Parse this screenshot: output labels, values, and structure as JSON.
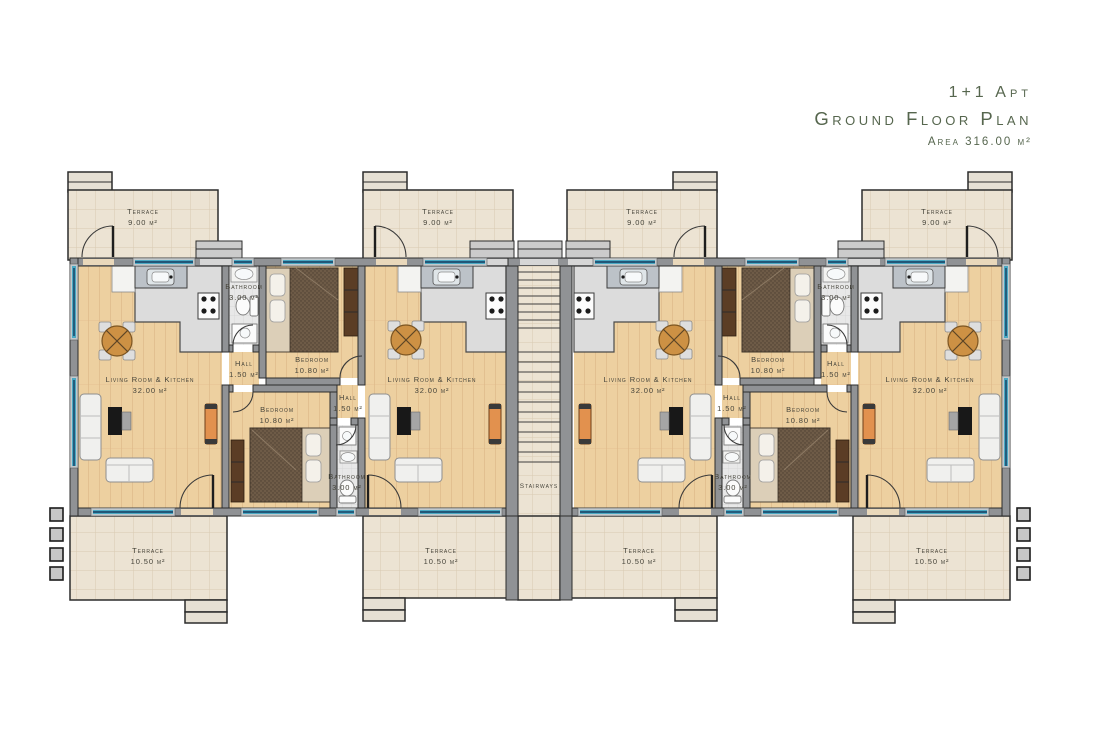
{
  "title": {
    "line1": "1+1 Apt",
    "line2": "Ground Floor Plan",
    "line3": "Area 316.00 m²"
  },
  "stairways": {
    "label": "Stairways"
  },
  "labels": {
    "terrace_top": {
      "name": "Terrace",
      "area": "9.00 m²"
    },
    "terrace_bottom": {
      "name": "Terrace",
      "area": "10.50 m²"
    },
    "living": {
      "name": "Living Room & Kitchen",
      "area": "32.00 m²"
    },
    "bedroom": {
      "name": "Bedroom",
      "area": "10.80 m²"
    },
    "hall": {
      "name": "Hall",
      "area": "1.50 m²"
    },
    "bathroom": {
      "name": "Bathroom",
      "area": "3.00 m²"
    }
  }
}
